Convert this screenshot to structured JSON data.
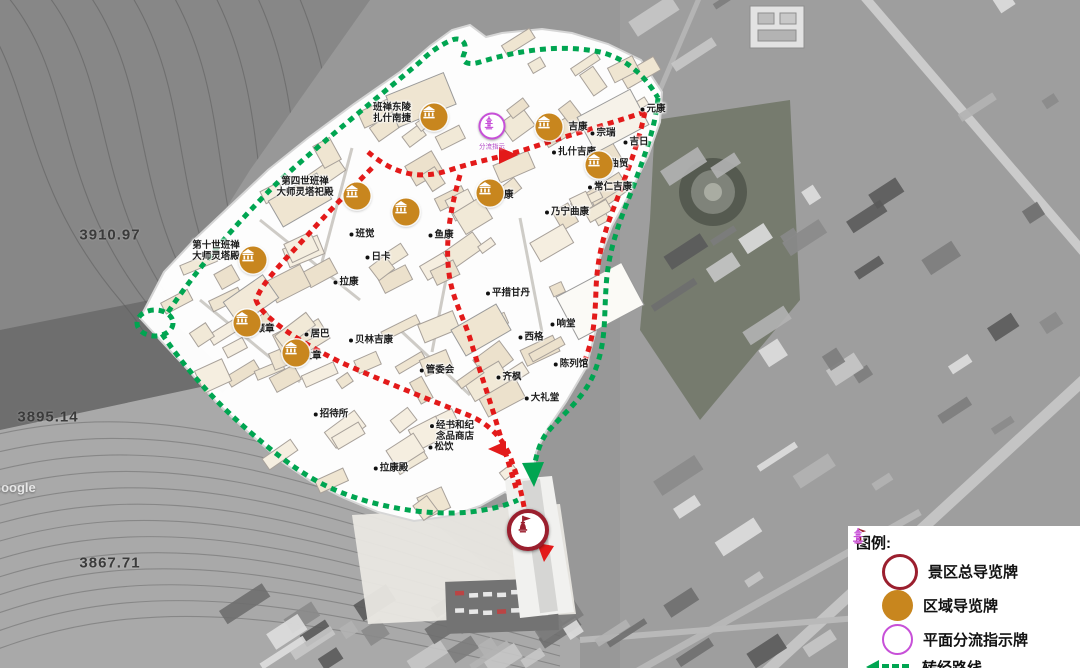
{
  "colors": {
    "kora_green": "#00a551",
    "tour_red": "#e31a1a",
    "main_sign": "#9b1f2e",
    "area_sign": "#c8861e",
    "split_sign": "#c750d8",
    "site_fill": "#ffffff",
    "building_fill": "#f1e7d3"
  },
  "map": {
    "watermark": "Google",
    "elevations": [
      {
        "text": "3910.97",
        "x": 110,
        "y": 235
      },
      {
        "text": "3895.14",
        "x": 48,
        "y": 417
      },
      {
        "text": "3867.71",
        "x": 110,
        "y": 563
      }
    ],
    "split_sign_caption": "分流指示",
    "labels": [
      {
        "text": "班禅东陵\n扎什南捷",
        "x": 392,
        "y": 114,
        "dot": false
      },
      {
        "text": "第四世班禅\n大师灵塔祀殿",
        "x": 305,
        "y": 188,
        "dot": false
      },
      {
        "text": "第十世班禅\n大师灵塔殿",
        "x": 216,
        "y": 252,
        "dot": false
      },
      {
        "text": "吉康",
        "x": 578,
        "y": 128,
        "dot": false
      },
      {
        "text": "宗瑞",
        "x": 603,
        "y": 134,
        "dot": true
      },
      {
        "text": "元康",
        "x": 653,
        "y": 110,
        "dot": true
      },
      {
        "text": "扎什吉康",
        "x": 574,
        "y": 153,
        "dot": true
      },
      {
        "text": "吉日",
        "x": 636,
        "y": 143,
        "dot": true
      },
      {
        "text": "曲贸",
        "x": 619,
        "y": 165,
        "dot": false
      },
      {
        "text": "常仁吉康",
        "x": 610,
        "y": 188,
        "dot": true
      },
      {
        "text": "乃宁曲康",
        "x": 567,
        "y": 213,
        "dot": true
      },
      {
        "text": "班觉",
        "x": 362,
        "y": 235,
        "dot": true
      },
      {
        "text": "鱼康",
        "x": 441,
        "y": 236,
        "dot": true
      },
      {
        "text": "日卡",
        "x": 378,
        "y": 258,
        "dot": true
      },
      {
        "text": "拉康",
        "x": 346,
        "y": 283,
        "dot": true
      },
      {
        "text": "孜康",
        "x": 504,
        "y": 196,
        "dot": false
      },
      {
        "text": "平措甘丹",
        "x": 508,
        "y": 294,
        "dot": true
      },
      {
        "text": "响堂",
        "x": 563,
        "y": 325,
        "dot": true
      },
      {
        "text": "西格",
        "x": 531,
        "y": 338,
        "dot": true
      },
      {
        "text": "居巴",
        "x": 317,
        "y": 335,
        "dot": true
      },
      {
        "text": "贝林吉康",
        "x": 371,
        "y": 341,
        "dot": true
      },
      {
        "text": "颇章",
        "x": 265,
        "y": 330,
        "dot": false
      },
      {
        "text": "拉章",
        "x": 312,
        "y": 357,
        "dot": false
      },
      {
        "text": "管委会",
        "x": 437,
        "y": 371,
        "dot": true
      },
      {
        "text": "齐枫",
        "x": 509,
        "y": 378,
        "dot": true
      },
      {
        "text": "陈列馆",
        "x": 571,
        "y": 365,
        "dot": true
      },
      {
        "text": "大礼堂",
        "x": 542,
        "y": 399,
        "dot": true
      },
      {
        "text": "招待所",
        "x": 331,
        "y": 415,
        "dot": true
      },
      {
        "text": "经书和纪\n念品商店",
        "x": 452,
        "y": 432,
        "dot": true
      },
      {
        "text": "松饮",
        "x": 441,
        "y": 448,
        "dot": true
      },
      {
        "text": "拉康殿",
        "x": 391,
        "y": 469,
        "dot": true
      }
    ],
    "area_sign_positions": [
      {
        "x": 434,
        "y": 117
      },
      {
        "x": 549,
        "y": 127
      },
      {
        "x": 599,
        "y": 165
      },
      {
        "x": 490,
        "y": 193
      },
      {
        "x": 357,
        "y": 196
      },
      {
        "x": 406,
        "y": 212
      },
      {
        "x": 253,
        "y": 260
      },
      {
        "x": 247,
        "y": 323
      },
      {
        "x": 296,
        "y": 353
      }
    ],
    "main_sign_position": {
      "x": 528,
      "y": 530
    },
    "split_sign_position": {
      "x": 492,
      "y": 126
    }
  },
  "legend": {
    "title": "图例:",
    "items": [
      {
        "kind": "badge",
        "icon": "main-sign-icon",
        "label": "景区总导览牌"
      },
      {
        "kind": "badge",
        "icon": "area-sign-icon",
        "label": "区域导览牌"
      },
      {
        "kind": "badge",
        "icon": "split-sign-icon",
        "label": "平面分流指示牌"
      },
      {
        "kind": "route",
        "icon": "kora-route-icon",
        "color_key": "kora_green",
        "label": "转经路线"
      },
      {
        "kind": "route",
        "icon": "tour-route-icon",
        "color_key": "tour_red",
        "label": "游览路线"
      }
    ]
  }
}
